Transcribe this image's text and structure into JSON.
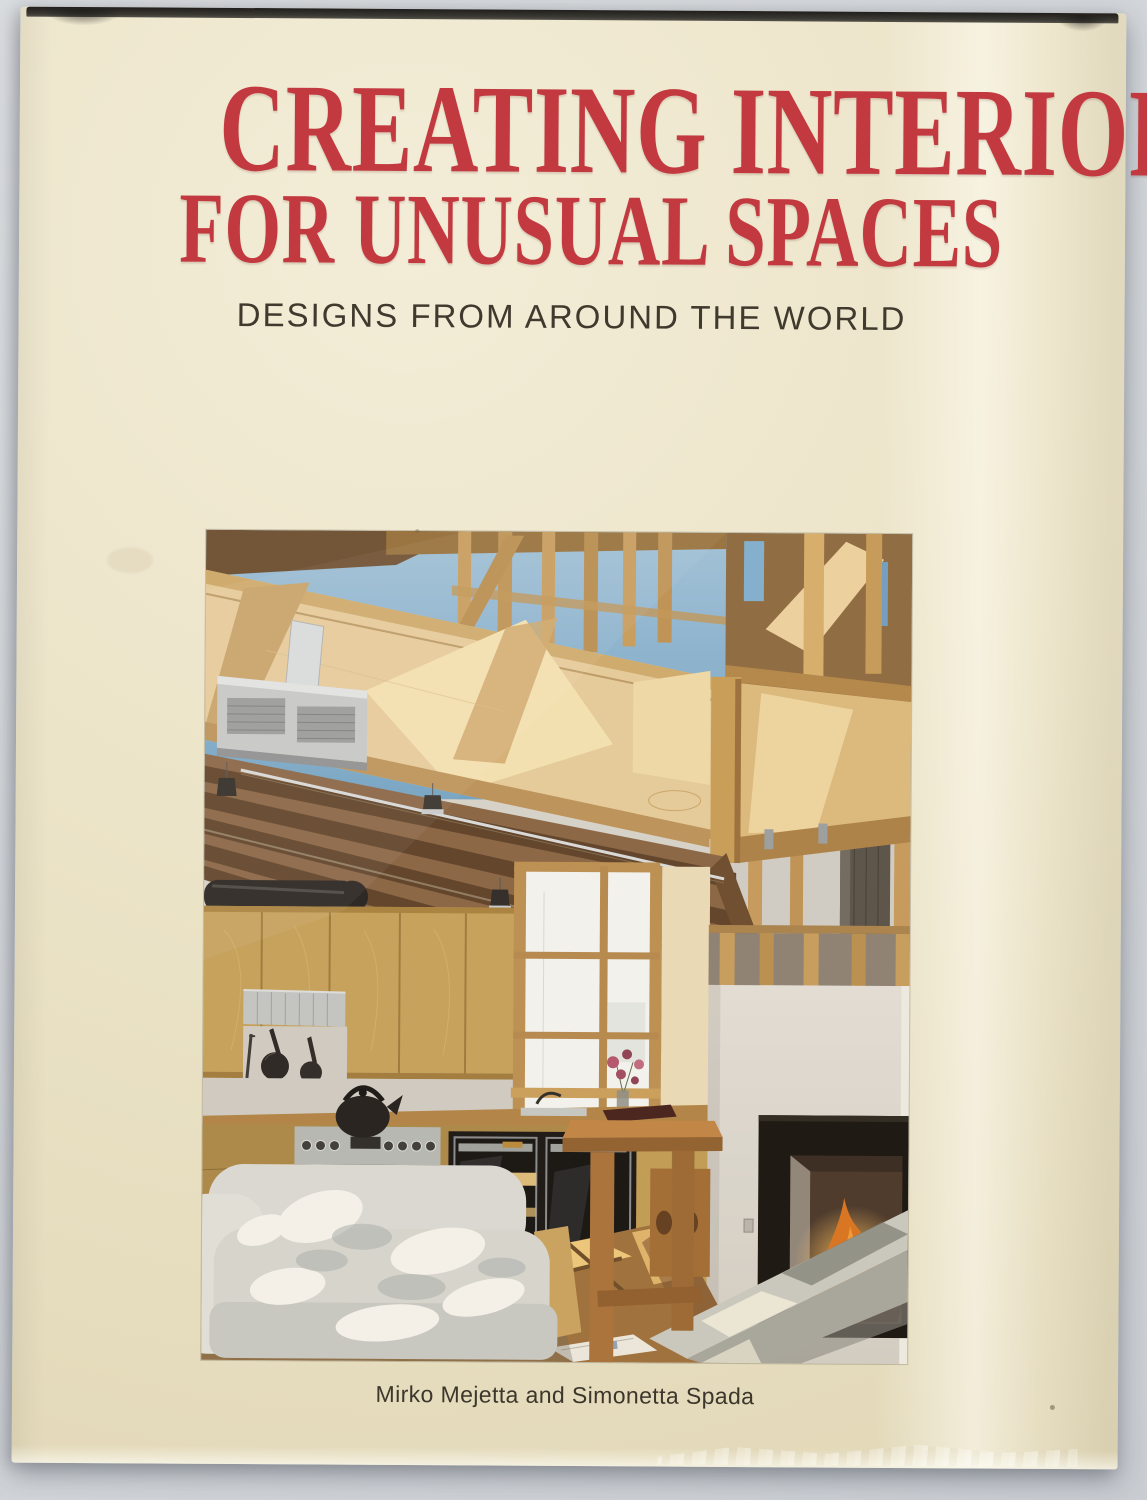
{
  "scene": {
    "backdrop_color": "#d2d6da",
    "description": "Hardcover book with a cream dust jacket photographed on a pale gray background"
  },
  "book": {
    "title_line1": "CREATING INTERIORS",
    "title_line2": "FOR UNUSUAL SPACES",
    "subtitle": "DESIGNS FROM AROUND THE WORLD",
    "author_line": "Mirko Mejetta and Simonetta Spada",
    "colors": {
      "jacket_cream": "#ece4c8",
      "title_red": "#c23a40",
      "text_dark": "#3f392d",
      "top_edge_dark": "#2f2d28"
    },
    "cover_photo": {
      "description": "Sunlit loft interior with exposed timber stud framing and mezzanine, open kitchen with birch cabinets and black ovens, tall window, white sofa, wooden bar table, and a white chimney breast with a burning fireplace and a concrete bench",
      "elements": [
        "sky-through-framing",
        "mezzanine-fascia",
        "ceiling-joists",
        "hvac-vent",
        "track-spotlights",
        "kitchen-cabinets",
        "range-hood",
        "hanging-pans",
        "kettle",
        "range",
        "double-oven",
        "window",
        "flowers",
        "bar-table",
        "stool",
        "white-sofa",
        "wood-floor",
        "bowl",
        "magazine",
        "chimney-breast",
        "fireplace-fire",
        "concrete-bench"
      ],
      "palette": {
        "sky": "#7fb0d2",
        "wood_light": "#e6cd9c",
        "wood_mid": "#c79d58",
        "joist_brown": "#5d4129",
        "wall_white": "#d6d4cd",
        "appliance_black": "#171513",
        "fire_orange": "#f09a33",
        "sofa_gray": "#d9dad4",
        "bench_gray": "#c9cac1",
        "floor_tan": "#9c6f3a"
      }
    }
  }
}
